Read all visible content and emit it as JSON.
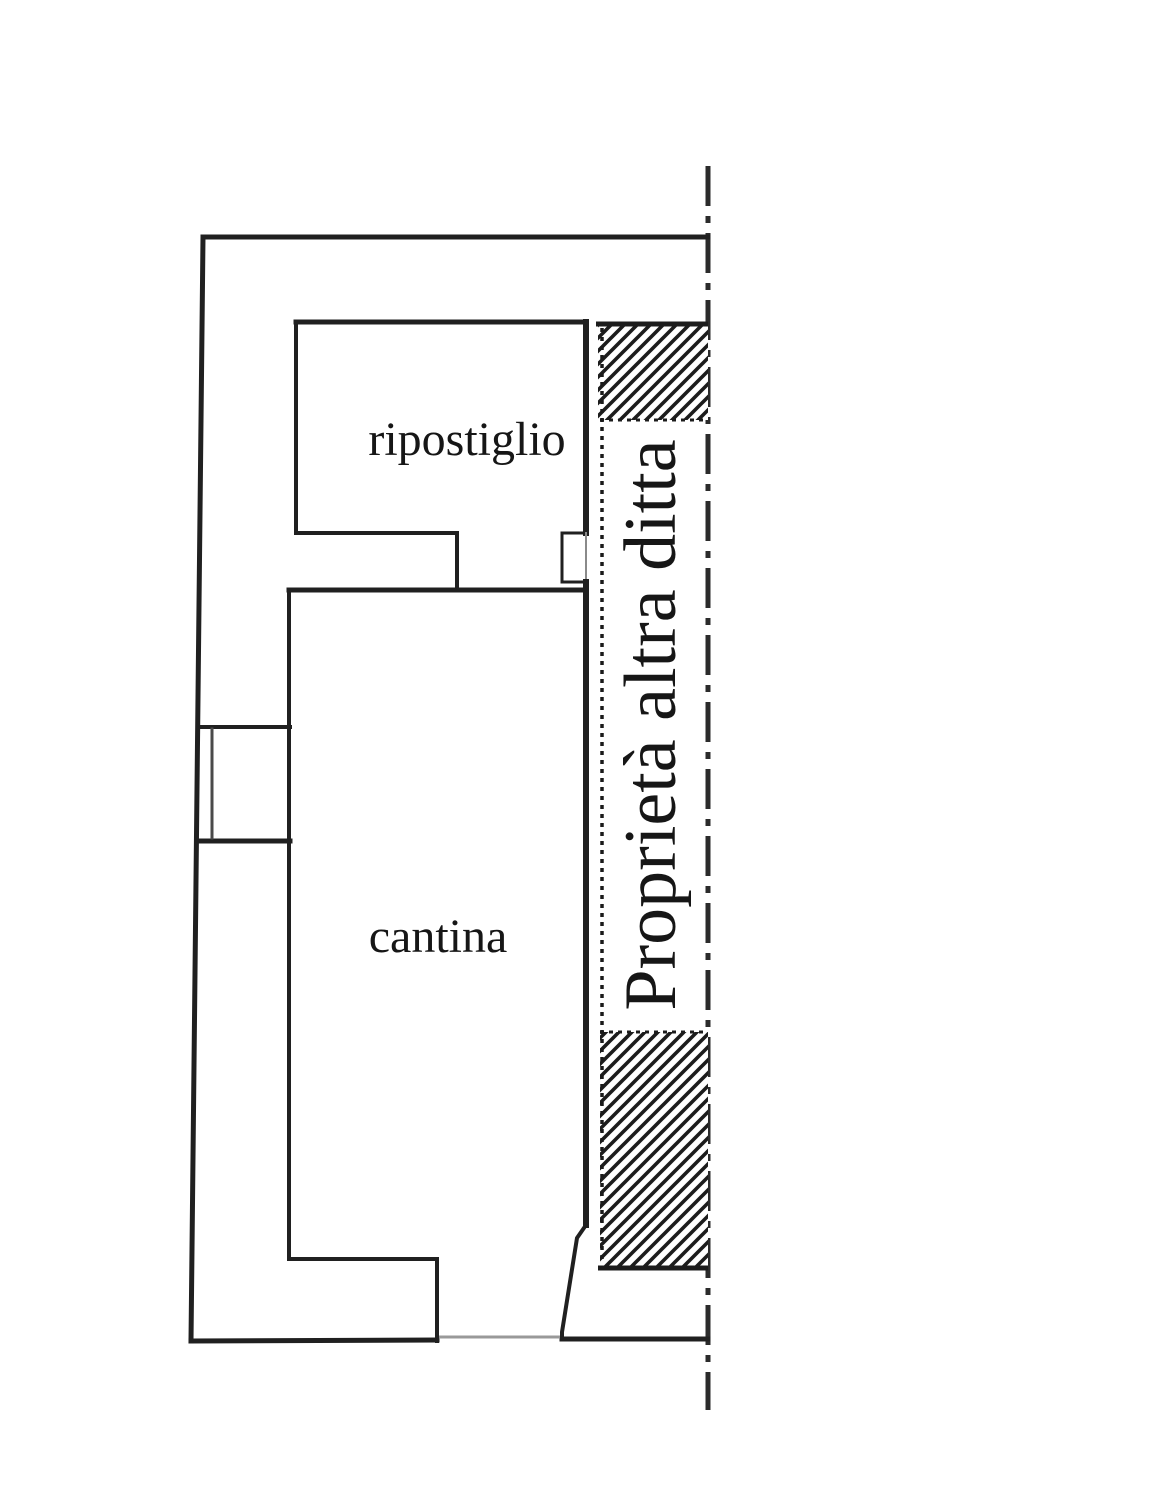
{
  "labels": {
    "room_top": "ripostiglio",
    "room_main": "cantina",
    "boundary": "Proprietà altra ditta"
  },
  "colors": {
    "wall_line": "#202020",
    "text": "#161616",
    "hatch": "#1c1c1c",
    "muted_line": "#999999",
    "boundary_line": "#2b2b2b",
    "background": "#ffffff"
  }
}
